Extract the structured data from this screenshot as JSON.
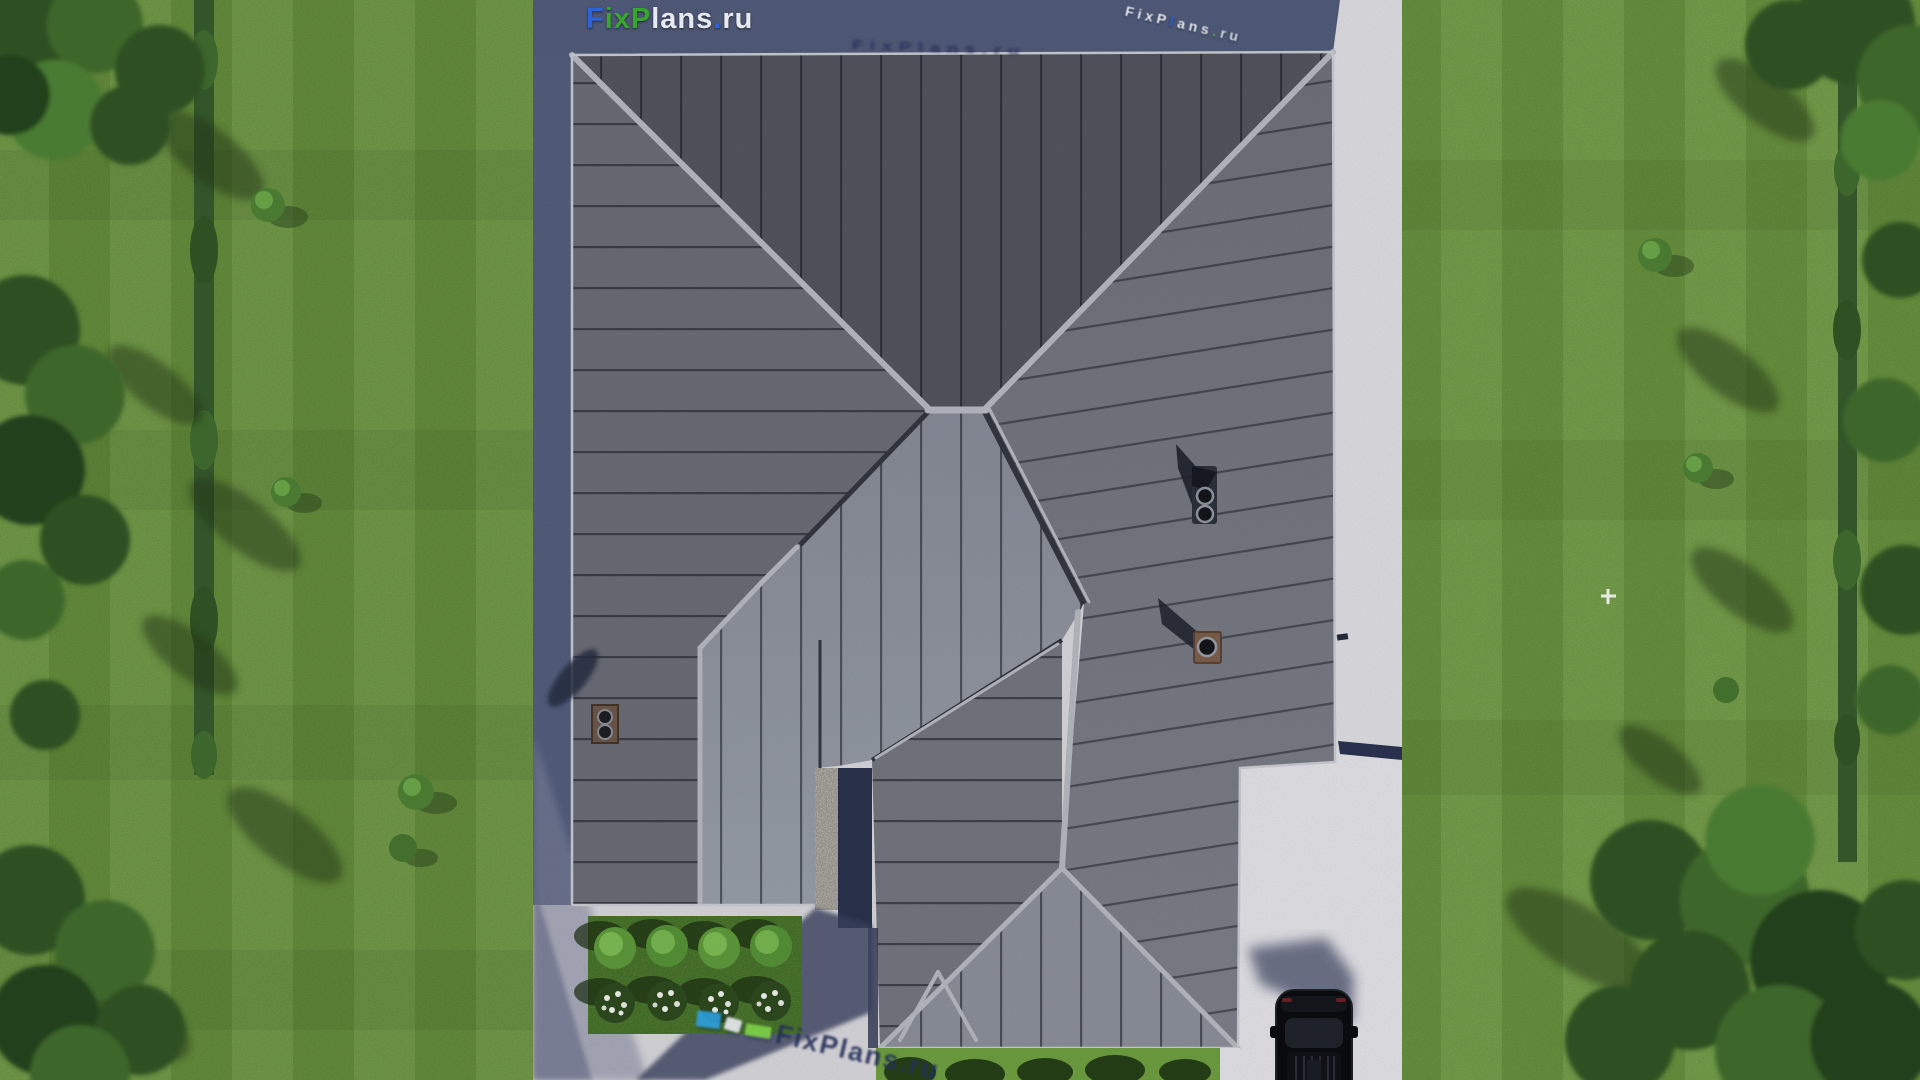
{
  "logo": {
    "text": "FixPlans.ru",
    "segments": [
      {
        "t": "F",
        "c": "#2e62d9"
      },
      {
        "t": "ix",
        "c": "#37a52e"
      },
      {
        "t": "P",
        "c": "#37a52e"
      },
      {
        "t": "lans",
        "c": "#e8eaf2"
      },
      {
        "t": ".",
        "c": "#2e62d9"
      },
      {
        "t": "ru",
        "c": "#e8eaf2"
      }
    ]
  },
  "watermarks": {
    "top_right": {
      "segments": [
        {
          "t": "FixP",
          "c": "#f4f5f8"
        },
        {
          "t": "l",
          "c": "#2e62d9"
        },
        {
          "t": "ans",
          "c": "#f4f5f8"
        },
        {
          "t": ".",
          "c": "#5fb93a"
        },
        {
          "t": "ru",
          "c": "#dfe2ea"
        }
      ]
    },
    "roof_shadow": {
      "text": "FixPlans.ru",
      "color": "#1d2750"
    },
    "bottom": {
      "text": "FixPlans.ru",
      "color": "#232f58",
      "chips": [
        {
          "c": "#2d9fe0"
        },
        {
          "c": "#e8eaf0"
        },
        {
          "c": "#7fd24a"
        }
      ]
    }
  },
  "scene": {
    "type": "aerial-3d-render",
    "subject": "top view of hip-roof house with standing-seam metal roof",
    "ground": {
      "lawn_left": "striped lawn with hedge and trees",
      "lawn_right": "striped lawn with hedge and trees",
      "driveway": "bottom-right with black SUV",
      "flower_bed": "bottom-left, 4 green bushes and 4 white-flower bushes",
      "porch": "white stone wall with deep shadow at bottom center"
    },
    "palette": {
      "roof_north": "#53565f",
      "roof_west": "#6b6e78",
      "roof_east": "#75787f",
      "roof_south": "#8f939e",
      "ridge_cap": "#b8bbc3",
      "concrete": "#dad9de",
      "concrete_bright": "#e6e5ea",
      "house_shadow": "#525d7c",
      "lawn": "#74a145",
      "hedge": "#33552a",
      "forest": "#2f5023"
    }
  }
}
